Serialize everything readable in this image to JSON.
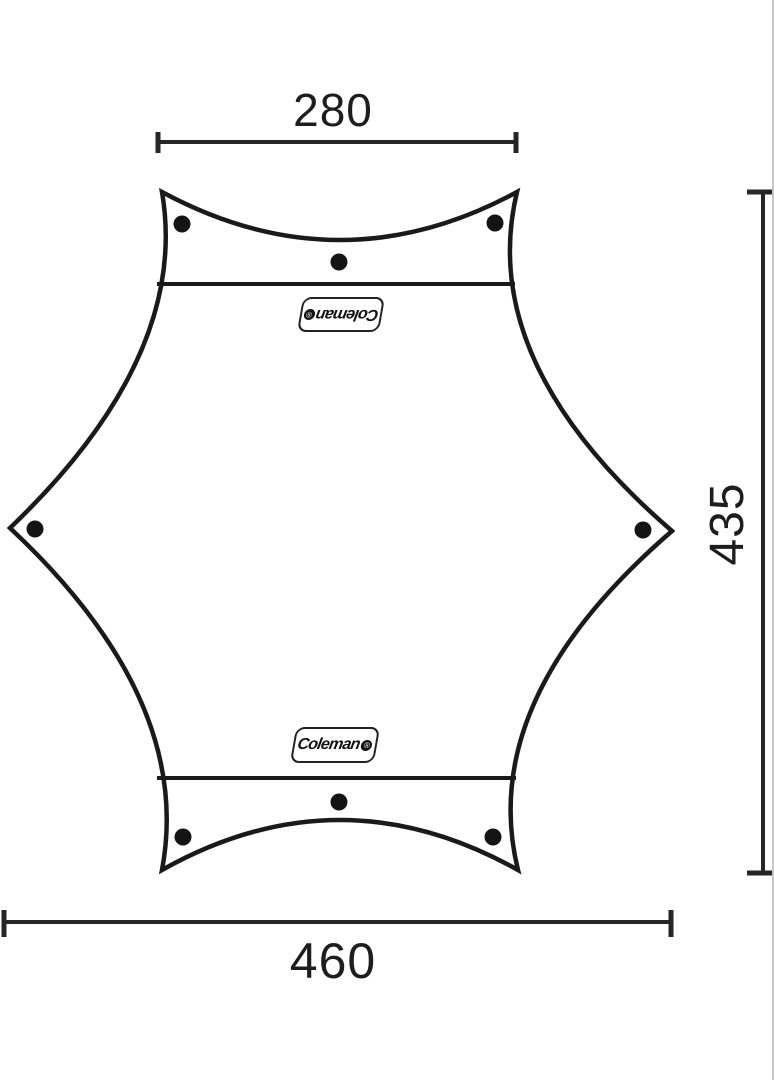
{
  "diagram": {
    "type": "dimension-diagram",
    "subject": "Coleman hexagonal tarp top view with tie-down points",
    "brand_badge": {
      "text": "Coleman",
      "reg": "®"
    },
    "dimensions": {
      "top_width": "280",
      "bottom_width": "460",
      "side_height": "435"
    },
    "grommet_count": 8,
    "colors": {
      "line": "#1a1a1a",
      "background": "#ffffff",
      "edge_line": "#c6c6c6"
    }
  }
}
